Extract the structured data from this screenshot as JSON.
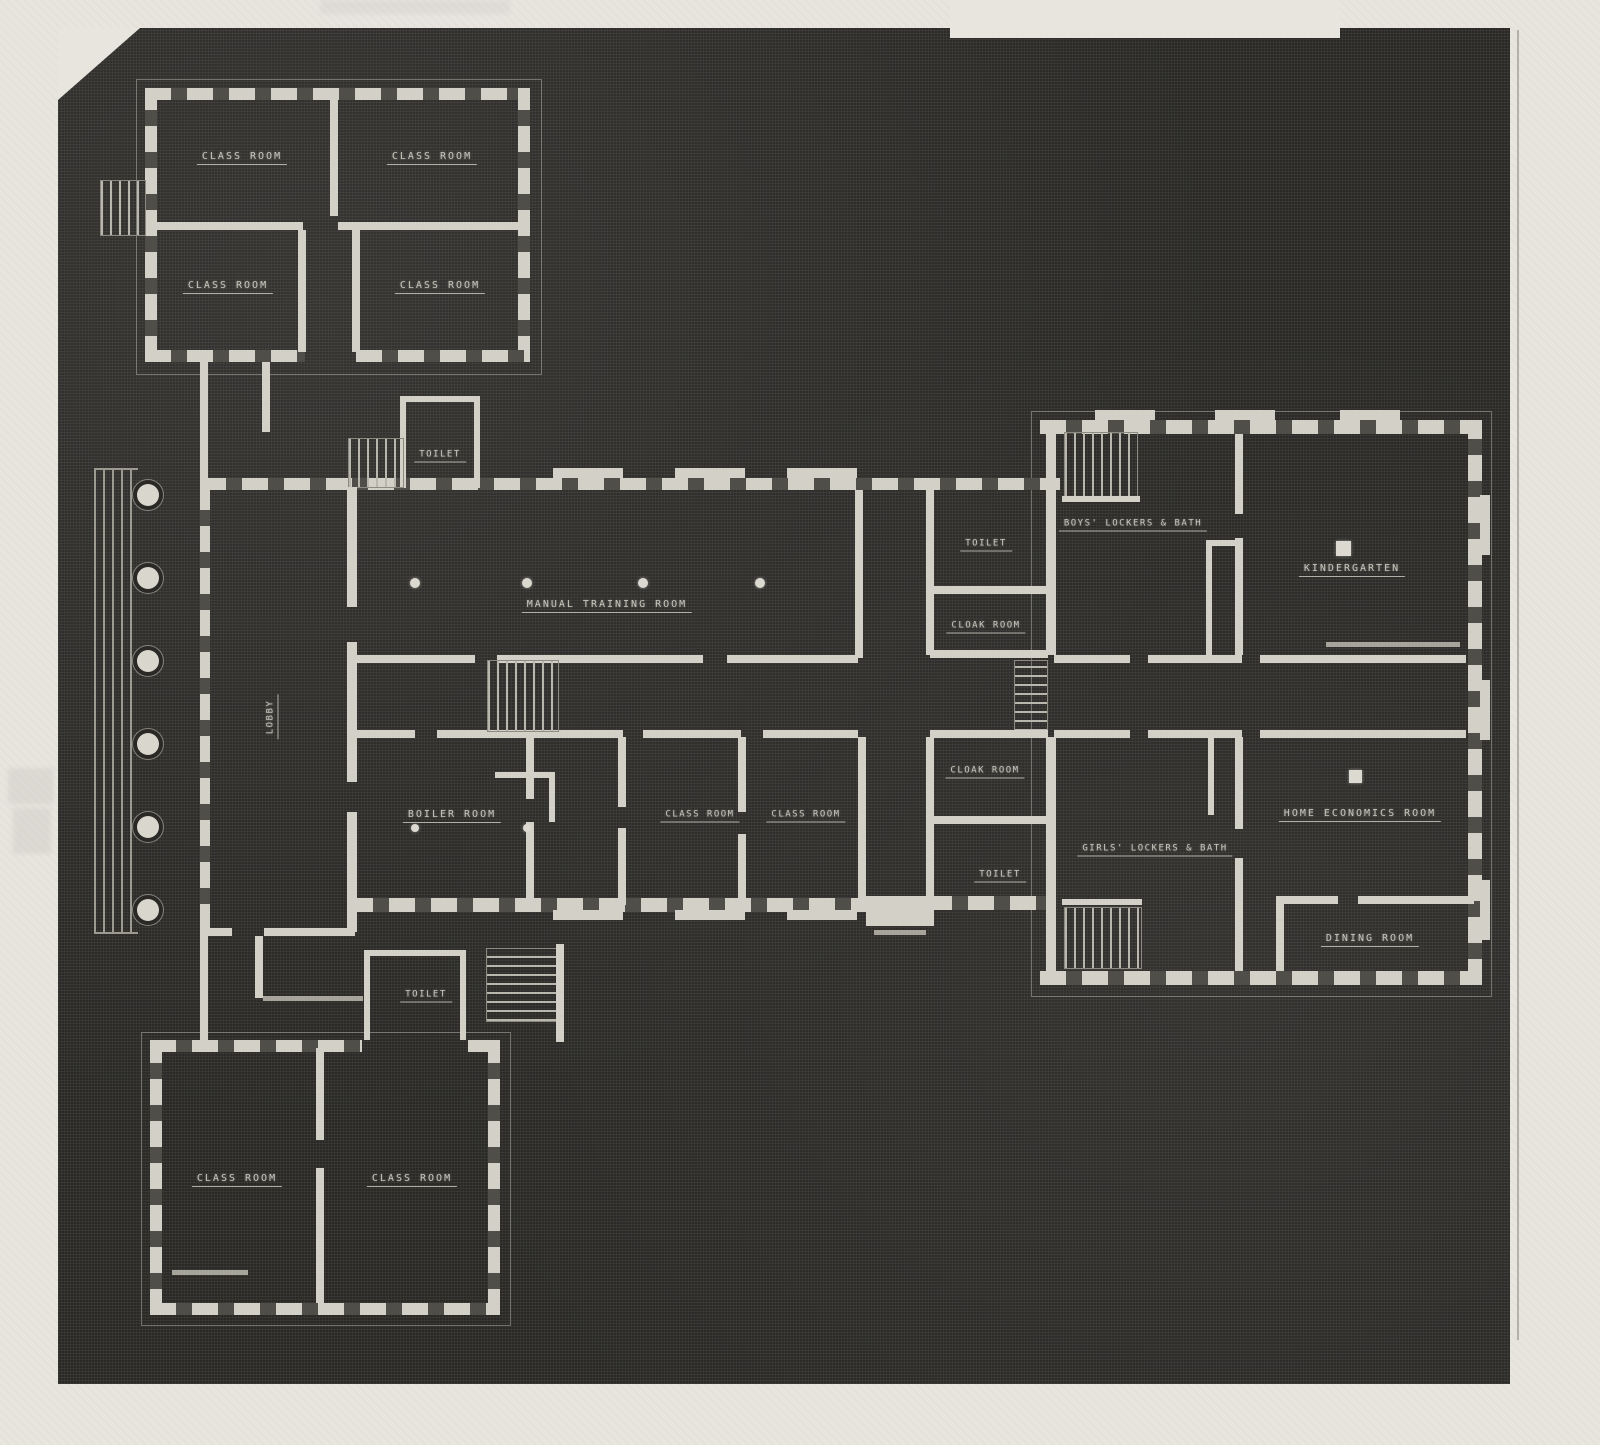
{
  "document": {
    "kind": "scanned blueprint floor plan of a school building",
    "style": "white line work on dark photostat background"
  },
  "colors": {
    "paper": "#e7e5de",
    "plan_background": "#2a2926",
    "wall": "#d3d0c7",
    "label": "#c7c4bb"
  },
  "rooms": [
    {
      "id": "classroom-nw-1",
      "label": "CLASS ROOM",
      "x": 242,
      "y": 158,
      "small": false,
      "vertical": false
    },
    {
      "id": "classroom-nw-2",
      "label": "CLASS ROOM",
      "x": 432,
      "y": 158,
      "small": false,
      "vertical": false
    },
    {
      "id": "classroom-nw-3",
      "label": "CLASS ROOM",
      "x": 228,
      "y": 287,
      "small": false,
      "vertical": false
    },
    {
      "id": "classroom-nw-4",
      "label": "CLASS ROOM",
      "x": 440,
      "y": 287,
      "small": false,
      "vertical": false
    },
    {
      "id": "toilet-north",
      "label": "TOILET",
      "x": 440,
      "y": 456,
      "small": true,
      "vertical": false
    },
    {
      "id": "manual-training",
      "label": "MANUAL TRAINING ROOM",
      "x": 607,
      "y": 606,
      "small": false,
      "vertical": false
    },
    {
      "id": "lobby",
      "label": "LOBBY",
      "x": 272,
      "y": 717,
      "small": true,
      "vertical": true
    },
    {
      "id": "boiler-room",
      "label": "BOILER ROOM",
      "x": 452,
      "y": 816,
      "small": false,
      "vertical": false
    },
    {
      "id": "classroom-c-1",
      "label": "CLASS ROOM",
      "x": 700,
      "y": 816,
      "small": true,
      "vertical": false
    },
    {
      "id": "classroom-c-2",
      "label": "CLASS ROOM",
      "x": 806,
      "y": 816,
      "small": true,
      "vertical": false
    },
    {
      "id": "toilet-upper-right",
      "label": "TOILET",
      "x": 986,
      "y": 545,
      "small": true,
      "vertical": false
    },
    {
      "id": "cloak-room-upper",
      "label": "CLOAK ROOM",
      "x": 986,
      "y": 627,
      "small": true,
      "vertical": false
    },
    {
      "id": "cloak-room-lower",
      "label": "CLOAK ROOM",
      "x": 985,
      "y": 772,
      "small": true,
      "vertical": false
    },
    {
      "id": "toilet-lower-right",
      "label": "TOILET",
      "x": 1000,
      "y": 876,
      "small": true,
      "vertical": false
    },
    {
      "id": "boys-lockers",
      "label": "BOYS' LOCKERS & BATH",
      "x": 1133,
      "y": 525,
      "small": true,
      "vertical": false
    },
    {
      "id": "kindergarten",
      "label": "KINDERGARTEN",
      "x": 1352,
      "y": 570,
      "small": false,
      "vertical": false
    },
    {
      "id": "girls-lockers",
      "label": "GIRLS' LOCKERS & BATH",
      "x": 1155,
      "y": 850,
      "small": true,
      "vertical": false
    },
    {
      "id": "home-economics",
      "label": "HOME ECONOMICS ROOM",
      "x": 1360,
      "y": 815,
      "small": false,
      "vertical": false
    },
    {
      "id": "dining-room",
      "label": "DINING ROOM",
      "x": 1370,
      "y": 940,
      "small": false,
      "vertical": false
    },
    {
      "id": "toilet-south",
      "label": "TOILET",
      "x": 426,
      "y": 996,
      "small": true,
      "vertical": false
    },
    {
      "id": "classroom-s-1",
      "label": "CLASS ROOM",
      "x": 237,
      "y": 1180,
      "small": false,
      "vertical": false
    },
    {
      "id": "classroom-s-2",
      "label": "CLASS ROOM",
      "x": 412,
      "y": 1180,
      "small": false,
      "vertical": false
    }
  ]
}
